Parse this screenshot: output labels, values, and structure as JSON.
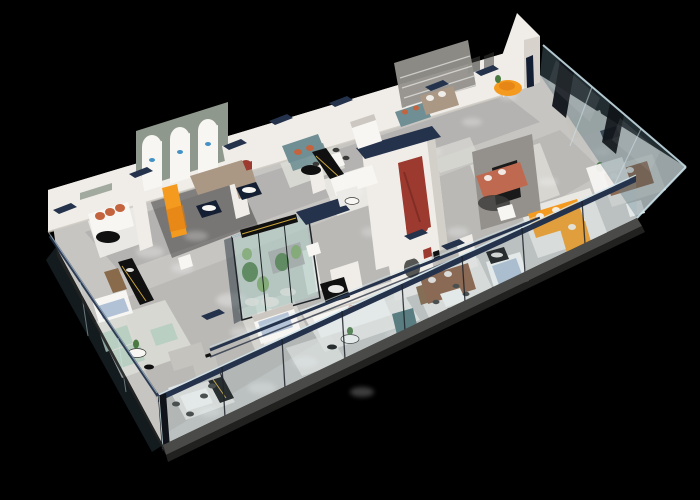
{
  "meta": {
    "description": "Isometric 3D cutaway rendering of a furniture showroom floor plan on a black background"
  },
  "canvas": {
    "width": 700,
    "height": 500,
    "background": "#000000"
  },
  "palette": {
    "bg": "#000000",
    "floor": "#c6c5c2",
    "floorDark": "#a3a2a0",
    "rug": "#dcdbd6",
    "rugWhite": "#ecebe7",
    "charcoal": "#3a3a38",
    "wallWhite": "#f0ede8",
    "wallShade": "#ccc8c1",
    "wallGray": "#94918c",
    "sage": "#8f988c",
    "navy": "#24324c",
    "navyDeep": "#151f33",
    "glassRail": "#cfe6ee",
    "glassPaneFront": "#8fb0ba30",
    "glassPaneRight": "#55707a66",
    "glassPaneLeft": "#3a505a55",
    "glassDarkFace": "#22303880",
    "postDark": "#1c2229",
    "pierDark": "#10141a",
    "slab": "#4a4a48",
    "slabDark": "#232322",
    "black": "#101010",
    "gold": "#c9a33c",
    "red": "#9c3a30",
    "redDark": "#7a2a22",
    "terracotta": "#c4643f",
    "rust": "#bf6a50",
    "orange": "#f49a1f",
    "orangeDeep": "#df7d12",
    "tan": "#ab9884",
    "brown": "#8a5a3e",
    "wood": "#82613f",
    "teal": "#6f8f94",
    "tealDark": "#4e7276",
    "mint": "#b9cfc2",
    "blue": "#aebfd4",
    "gray2": "#c4c3be",
    "white": "#f7f6f3",
    "green": "#4a7a42",
    "greenLight": "#7aa45f",
    "pebble": "#e3e2da",
    "glow": "#ffffff",
    "logoBlue": "#2f86c0",
    "aquaGlass": "#a9c4cc3d",
    "aquaFrame": "#1e2326",
    "streak": "#ffffff14"
  },
  "scene": {
    "zones": [
      "back-wall-gallery",
      "arched-lightbox-bay",
      "sofa-display-bays",
      "bedding-display-bays",
      "indoor-garden-terrarium",
      "central-red-arch-volume",
      "dining-set-displays",
      "corner-room-with-figure",
      "right-glass-facade-rooms",
      "front-glass-balustrade-walk"
    ],
    "furniture": [
      {
        "item": "white-sofa-terracotta-cushions",
        "color": "#c4643f"
      },
      {
        "item": "tan-l-sofa",
        "color": "#ab9884"
      },
      {
        "item": "bright-orange-lounge",
        "color": "#f49a1f"
      },
      {
        "item": "teal-fabric-sofas",
        "color": "#6f8f94"
      },
      {
        "item": "white-modular-sofas",
        "color": "#f7f6f3"
      },
      {
        "item": "mint-green-modular-sofa",
        "color": "#b9cfc2"
      },
      {
        "item": "gray-l-sofa",
        "color": "#c4c3be"
      },
      {
        "item": "rust-leather-sofa",
        "color": "#bf6a50"
      },
      {
        "item": "orange-l-sofa",
        "color": "#f49a1f"
      },
      {
        "item": "brown-leather-sofas",
        "color": "#8a5a3e"
      },
      {
        "item": "blue-and-white-bed-displays",
        "color": "#aebfd4"
      },
      {
        "item": "black-display-counters-gold-trim",
        "color": "#c9a33c"
      },
      {
        "item": "navy-display-tables",
        "color": "#151f33"
      },
      {
        "item": "white-dining-sets",
        "color": "#f7f6f3"
      },
      {
        "item": "teal-cube-pouf",
        "color": "#4e7276"
      },
      {
        "item": "black-oval-coffee-tables",
        "color": "#101010"
      },
      {
        "item": "indoor-plants-and-cacti",
        "color": "#4a7a42"
      }
    ],
    "features": [
      "glass-curtain-wall-right",
      "glass-balustrade-front",
      "navy-wall-caps",
      "three-arched-lightboxes-with-blue-logos",
      "red-arch-niche",
      "striped-feature-wall",
      "terrarium-glass-box",
      "ceiling-spotlight-glows",
      "standing-figure-cutout"
    ],
    "lighting": {
      "spot_count": 22,
      "glow_color": "#ffffff"
    }
  }
}
